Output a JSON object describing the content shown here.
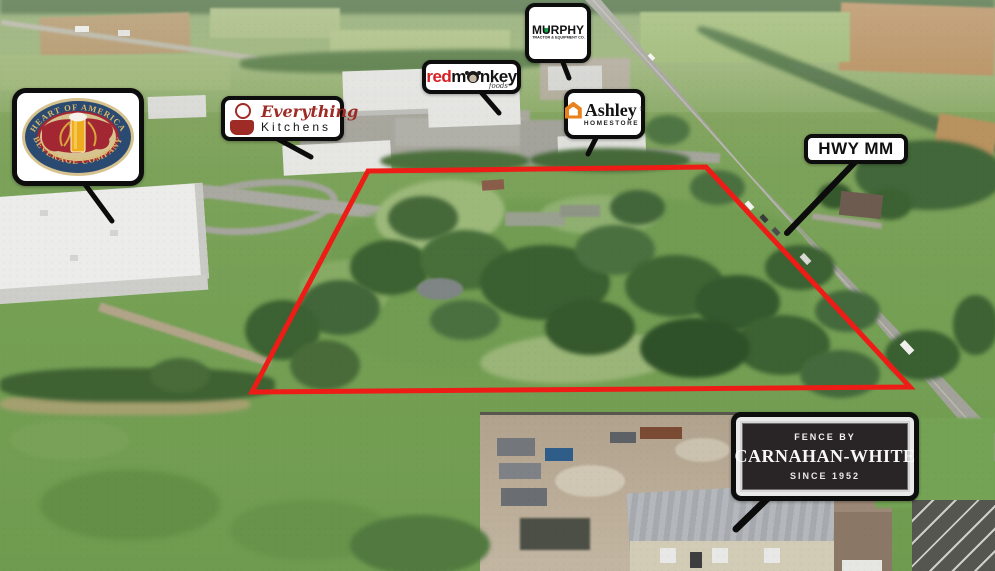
{
  "annotations": {
    "heart_of_america": {
      "arc_top": "HEART OF AMERICA",
      "arc_bottom": "BEVERAGE COMPANY"
    },
    "everything_kitchens": {
      "line1": "Everything",
      "line2": "Kitchens"
    },
    "redmonkey": {
      "part_red": "red",
      "part_m": "m",
      "part_nkey": "nkey",
      "sub": "foods"
    },
    "murphy": {
      "part_m": "M",
      "part_u": "U",
      "part_rphy": "RPHY",
      "sub": "TRACTOR & EQUIPMENT CO."
    },
    "ashley": {
      "name": "Ashley",
      "trademark": "®",
      "sub": "HOMESTORE"
    },
    "hwy_mm": {
      "label": "HWY MM"
    },
    "carnahan_white": {
      "line1": "FENCE BY",
      "line2": "CARNAHAN-WHITE",
      "line3": "SINCE 1952"
    }
  },
  "colors": {
    "boundary_red": "#ee1c17",
    "label_border": "#0d0d0d",
    "label_bg": "#ffffff",
    "murphy_green": "#17a24a",
    "ashley_orange": "#e8821e",
    "kitchens_red": "#9e2b25",
    "redmonkey_red": "#d91f26",
    "beverage_navy": "#2a4a72",
    "beverage_cream": "#d7c38f",
    "beverage_red": "#a32733",
    "beverage_gold_text": "#d9b667",
    "carnahan_plaque": "#292425"
  }
}
